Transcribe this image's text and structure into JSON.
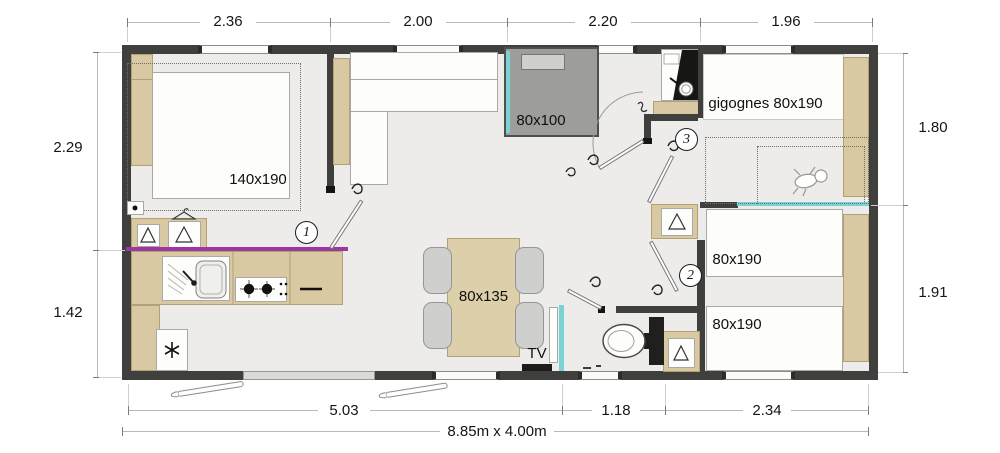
{
  "plan": {
    "overall_size": "8.85m x 4.00m",
    "dims": {
      "top": [
        "2.36",
        "2.00",
        "2.20",
        "1.96"
      ],
      "bottom": [
        "5.03",
        "1.18",
        "2.34"
      ],
      "left": [
        "2.29",
        "1.42"
      ],
      "right": [
        "1.80",
        "1.91"
      ]
    },
    "labels": {
      "master_bed": "140x190",
      "shower": "80x100",
      "gigognes": "gigognes 80x190",
      "twin_bed_top": "80x190",
      "twin_bed_bottom": "80x190",
      "table": "80x135",
      "tv": "TV"
    },
    "markers": [
      "1",
      "2",
      "3"
    ],
    "colors": {
      "wall": "#3f3f3d",
      "floor": "#edecea",
      "wood": "#d8c9a2",
      "worktop_edge": "#9c36a0",
      "sliding_door": "#79d2d3",
      "shower_tray": "#9d9d9b"
    }
  }
}
